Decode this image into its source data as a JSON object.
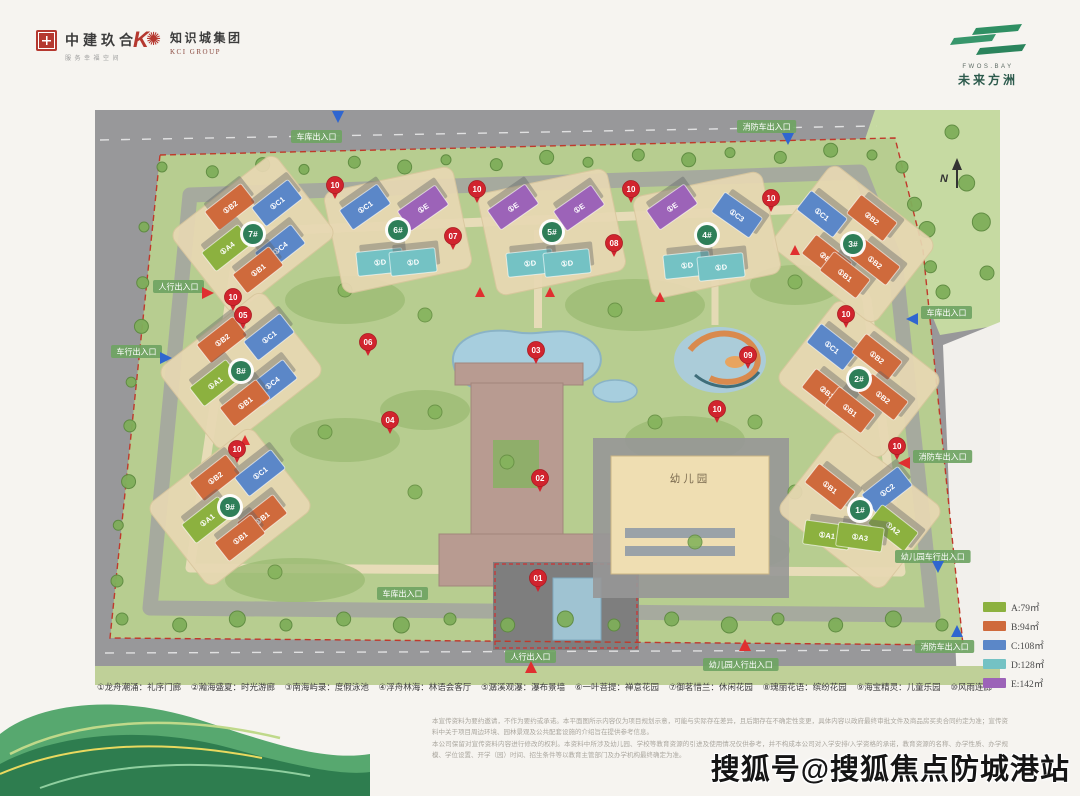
{
  "header": {
    "cscec": {
      "name": "中建玖合",
      "tagline": "服务幸福空间"
    },
    "kci": {
      "name": "知识城集团",
      "sub": "KCI GROUP"
    },
    "fwos": {
      "brand": "FWOS.BAY",
      "name": "未来方洲"
    }
  },
  "map": {
    "compass": "N",
    "kindergarten_label": "幼儿园",
    "colors": {
      "A": "#8cb13f",
      "B": "#cf6a3c",
      "C": "#5b87c8",
      "D": "#74c2c4",
      "E": "#9c63b8",
      "badge": "#2e7e58",
      "marker": "#d1242e",
      "entrance": "#6fa463",
      "arrow_blue": "#2f66d0",
      "arrow_red": "#e03030",
      "boundary_red": "#c0392b"
    },
    "buildings": [
      {
        "id": "1#",
        "badge": {
          "x": 765,
          "y": 400
        },
        "units": [
          {
            "label": "①B1",
            "t": "B",
            "x": 735,
            "y": 377,
            "r": 38
          },
          {
            "label": "①C2",
            "t": "C",
            "x": 792,
            "y": 380,
            "r": -38
          },
          {
            "label": "①A2",
            "t": "A",
            "x": 798,
            "y": 418,
            "r": 38
          },
          {
            "label": "①A1",
            "t": "A",
            "x": 732,
            "y": 425,
            "r": 8
          },
          {
            "label": "①A3",
            "t": "A",
            "x": 765,
            "y": 427,
            "r": 8
          }
        ]
      },
      {
        "id": "2#",
        "badge": {
          "x": 764,
          "y": 269
        },
        "units": [
          {
            "label": "①C1",
            "t": "C",
            "x": 737,
            "y": 237,
            "r": 38
          },
          {
            "label": "①B2",
            "t": "B",
            "x": 782,
            "y": 247,
            "r": 38
          },
          {
            "label": "②B1",
            "t": "B",
            "x": 732,
            "y": 282,
            "r": 38
          },
          {
            "label": "①B1",
            "t": "B",
            "x": 755,
            "y": 300,
            "r": 38
          },
          {
            "label": "①B2",
            "t": "B",
            "x": 788,
            "y": 287,
            "r": 38
          }
        ]
      },
      {
        "id": "3#",
        "badge": {
          "x": 758,
          "y": 134
        },
        "units": [
          {
            "label": "①C1",
            "t": "C",
            "x": 727,
            "y": 104,
            "r": 38
          },
          {
            "label": "②B2",
            "t": "B",
            "x": 777,
            "y": 108,
            "r": 38
          },
          {
            "label": "②B1",
            "t": "B",
            "x": 732,
            "y": 148,
            "r": 38
          },
          {
            "label": "①B1",
            "t": "B",
            "x": 750,
            "y": 165,
            "r": 38
          },
          {
            "label": "①B2",
            "t": "B",
            "x": 780,
            "y": 152,
            "r": 38
          }
        ]
      },
      {
        "id": "4#",
        "badge": {
          "x": 612,
          "y": 125
        },
        "units": [
          {
            "label": "①E",
            "t": "E",
            "x": 577,
            "y": 97,
            "r": -35
          },
          {
            "label": "①C3",
            "t": "C",
            "x": 642,
            "y": 105,
            "r": 35
          },
          {
            "label": "①D",
            "t": "D",
            "x": 592,
            "y": 155,
            "r": -6
          },
          {
            "label": "①D",
            "t": "D",
            "x": 626,
            "y": 157,
            "r": -6
          }
        ]
      },
      {
        "id": "5#",
        "badge": {
          "x": 457,
          "y": 122
        },
        "units": [
          {
            "label": "①E",
            "t": "E",
            "x": 418,
            "y": 97,
            "r": -35
          },
          {
            "label": "①E",
            "t": "E",
            "x": 484,
            "y": 98,
            "r": -35
          },
          {
            "label": "①D",
            "t": "D",
            "x": 435,
            "y": 153,
            "r": -6
          },
          {
            "label": "①D",
            "t": "D",
            "x": 472,
            "y": 153,
            "r": -6
          }
        ]
      },
      {
        "id": "6#",
        "badge": {
          "x": 303,
          "y": 120
        },
        "units": [
          {
            "label": "①C1",
            "t": "C",
            "x": 270,
            "y": 97,
            "r": -35
          },
          {
            "label": "①E",
            "t": "E",
            "x": 328,
            "y": 98,
            "r": -35
          },
          {
            "label": "①D",
            "t": "D",
            "x": 285,
            "y": 152,
            "r": -6
          },
          {
            "label": "①D",
            "t": "D",
            "x": 318,
            "y": 152,
            "r": -6
          }
        ]
      },
      {
        "id": "7#",
        "badge": {
          "x": 158,
          "y": 124
        },
        "units": [
          {
            "label": "①B2",
            "t": "B",
            "x": 135,
            "y": 97,
            "r": -38
          },
          {
            "label": "①C1",
            "t": "C",
            "x": 182,
            "y": 93,
            "r": -38
          },
          {
            "label": "①A4",
            "t": "A",
            "x": 132,
            "y": 138,
            "r": -38
          },
          {
            "label": "①C4",
            "t": "C",
            "x": 185,
            "y": 138,
            "r": -38
          },
          {
            "label": "①B1",
            "t": "B",
            "x": 163,
            "y": 160,
            "r": -38
          }
        ]
      },
      {
        "id": "8#",
        "badge": {
          "x": 146,
          "y": 261
        },
        "units": [
          {
            "label": "①B2",
            "t": "B",
            "x": 127,
            "y": 230,
            "r": -38
          },
          {
            "label": "①C1",
            "t": "C",
            "x": 174,
            "y": 227,
            "r": -38
          },
          {
            "label": "①A1",
            "t": "A",
            "x": 120,
            "y": 273,
            "r": -38
          },
          {
            "label": "①C4",
            "t": "C",
            "x": 177,
            "y": 273,
            "r": -38
          },
          {
            "label": "①B1",
            "t": "B",
            "x": 150,
            "y": 293,
            "r": -38
          }
        ]
      },
      {
        "id": "9#",
        "badge": {
          "x": 135,
          "y": 397
        },
        "units": [
          {
            "label": "①B2",
            "t": "B",
            "x": 120,
            "y": 368,
            "r": -38
          },
          {
            "label": "①C1",
            "t": "C",
            "x": 165,
            "y": 363,
            "r": -38
          },
          {
            "label": "①A1",
            "t": "A",
            "x": 112,
            "y": 410,
            "r": -38
          },
          {
            "label": "①B1",
            "t": "B",
            "x": 167,
            "y": 408,
            "r": -38
          },
          {
            "label": "①B1",
            "t": "B",
            "x": 145,
            "y": 428,
            "r": -38
          }
        ]
      }
    ],
    "markers": [
      {
        "n": "01",
        "x": 443,
        "y": 468
      },
      {
        "n": "02",
        "x": 445,
        "y": 368
      },
      {
        "n": "03",
        "x": 441,
        "y": 240
      },
      {
        "n": "04",
        "x": 295,
        "y": 310
      },
      {
        "n": "05",
        "x": 148,
        "y": 205
      },
      {
        "n": "06",
        "x": 273,
        "y": 232
      },
      {
        "n": "07",
        "x": 358,
        "y": 126
      },
      {
        "n": "08",
        "x": 519,
        "y": 133
      },
      {
        "n": "09",
        "x": 653,
        "y": 245
      },
      {
        "n": "10",
        "x": 240,
        "y": 75
      },
      {
        "n": "10",
        "x": 382,
        "y": 79
      },
      {
        "n": "10",
        "x": 536,
        "y": 79
      },
      {
        "n": "10",
        "x": 676,
        "y": 88
      },
      {
        "n": "10",
        "x": 138,
        "y": 187
      },
      {
        "n": "10",
        "x": 142,
        "y": 339
      },
      {
        "n": "10",
        "x": 622,
        "y": 299
      },
      {
        "n": "10",
        "x": 751,
        "y": 204
      },
      {
        "n": "10",
        "x": 802,
        "y": 336
      }
    ],
    "entrances": [
      {
        "text": "车库出入口",
        "x": 196,
        "y": 20,
        "arrow": {
          "c": "blue",
          "d": "down",
          "x": 243,
          "y": 6
        }
      },
      {
        "text": "消防车出入口",
        "x": 642,
        "y": 10,
        "arrow": {
          "c": "blue",
          "d": "down",
          "x": 693,
          "y": 28
        }
      },
      {
        "text": "人行出入口",
        "x": 58,
        "y": 170,
        "arrow": {
          "c": "red",
          "d": "right",
          "x": 112,
          "y": 183
        }
      },
      {
        "text": "车行出入口",
        "x": 16,
        "y": 235,
        "arrow": {
          "c": "blue",
          "d": "right",
          "x": 70,
          "y": 248
        }
      },
      {
        "text": "车库出入口",
        "x": 826,
        "y": 196,
        "arrow": {
          "c": "blue",
          "d": "left",
          "x": 818,
          "y": 209
        }
      },
      {
        "text": "消防车出入口",
        "x": 818,
        "y": 340,
        "arrow": {
          "c": "red",
          "d": "left",
          "x": 810,
          "y": 353
        }
      },
      {
        "text": "幼儿园车行出入口",
        "x": 800,
        "y": 440,
        "arrow": {
          "c": "blue",
          "d": "down",
          "x": 843,
          "y": 456
        }
      },
      {
        "text": "消防车出入口",
        "x": 820,
        "y": 530,
        "arrow": {
          "c": "blue",
          "d": "up",
          "x": 862,
          "y": 522
        }
      },
      {
        "text": "车库出入口",
        "x": 282,
        "y": 477
      },
      {
        "text": "人行出入口",
        "x": 410,
        "y": 540,
        "arrow": {
          "c": "red",
          "d": "up",
          "x": 436,
          "y": 558
        }
      },
      {
        "text": "幼儿园人行出入口",
        "x": 608,
        "y": 548,
        "arrow": {
          "c": "red",
          "d": "up",
          "x": 650,
          "y": 536
        }
      }
    ]
  },
  "legend": {
    "items": [
      {
        "label": "A:79㎡",
        "color": "#8cb13f"
      },
      {
        "label": "B:94㎡",
        "color": "#cf6a3c"
      },
      {
        "label": "C:108㎡",
        "color": "#5b87c8"
      },
      {
        "label": "D:128㎡",
        "color": "#74c2c4"
      },
      {
        "label": "E:142㎡",
        "color": "#9c63b8"
      }
    ]
  },
  "amenities": {
    "items": [
      "①龙舟潮涌：礼序门廊",
      "②瀚海盛夏：时光游廊",
      "③南海屿录：度假泳池",
      "④浮舟林海：林语会客厅",
      "⑤潺溪观瀑：瀑布景墙",
      "⑥一叶菩提：禅意花园",
      "⑦御茗惜兰：休闲花园",
      "⑧瑰丽花语：缤纷花园",
      "⑨海宝精灵：儿童乐园",
      "⑩风雨连廊"
    ]
  },
  "disclaimer": {
    "line1": "本宣传资料为要约邀请，不作为要约或承诺。本平面图所示内容仅为项目规划示意，可能与实际存在差异，且后期存在不确定性变更，具体内容以政府最终审批文件及商品房买卖合同约定为准；宣传资料中关于项目周边环境、园林景观及公共配套设施的介绍旨在提供参考信息。",
    "line2": "本公司保留对宣传资料内容进行修改的权利。本资料中所涉及幼儿园、学校等教育资源的引进及使用情况仅供参考，并不构成本公司对入学安排/入学资格的承诺，教育资源的名称、办学性质、办学规模、学位设置、开学（园）时间、招生条件等以教育主管部门及办学机构最终确定为准。"
  },
  "watermark": {
    "text": "搜狐号@搜狐焦点防城港站"
  }
}
